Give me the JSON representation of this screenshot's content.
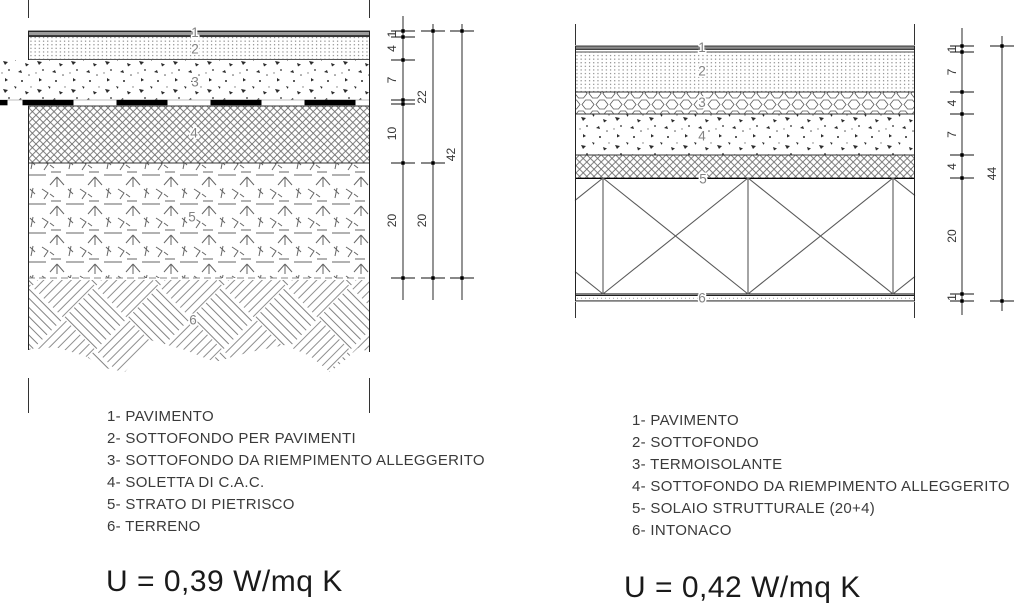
{
  "page": {
    "background": "#ffffff",
    "ink_color": "#000000",
    "pattern_color": "#777777",
    "text_color": "#333333"
  },
  "left_section": {
    "layer_numbers": [
      "1",
      "2",
      "3",
      "4",
      "5",
      "6"
    ],
    "dim_chain_inner": [
      "1",
      "4",
      "7",
      "10",
      "20"
    ],
    "dim_chain_mid": [
      "22",
      "20"
    ],
    "dim_chain_outer": [
      "42"
    ],
    "legend": [
      "1- PAVIMENTO",
      "2- SOTTOFONDO PER PAVIMENTI",
      "3- SOTTOFONDO DA RIEMPIMENTO ALLEGGERITO",
      "4- SOLETTA DI C.A.C.",
      "5- STRATO DI PIETRISCO",
      "6- TERRENO"
    ],
    "u_value": "U = 0,39 W/mq K"
  },
  "right_section": {
    "layer_numbers": [
      "1",
      "2",
      "3",
      "4",
      "5",
      "6"
    ],
    "dim_chain_inner": [
      "1",
      "7",
      "4",
      "7",
      "4",
      "20",
      "1"
    ],
    "dim_chain_outer": [
      "44"
    ],
    "legend": [
      "1- PAVIMENTO",
      "2- SOTTOFONDO",
      "3- TERMOISOLANTE",
      "4- SOTTOFONDO DA RIEMPIMENTO ALLEGGERITO",
      "5- SOLAIO STRUTTURALE (20+4)",
      "6- INTONACO"
    ],
    "u_value": "U = 0,42 W/mq K"
  }
}
